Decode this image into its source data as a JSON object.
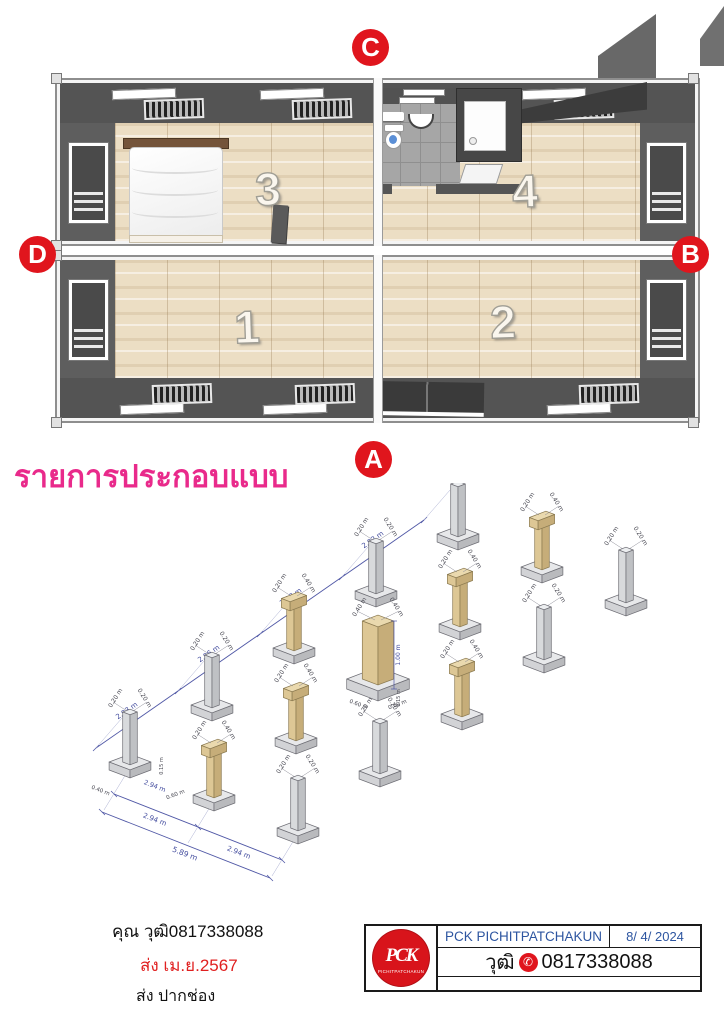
{
  "plan": {
    "rooms": [
      {
        "label": "1"
      },
      {
        "label": "2"
      },
      {
        "label": "3"
      },
      {
        "label": "4"
      }
    ],
    "markers": [
      {
        "label": "A"
      },
      {
        "label": "B"
      },
      {
        "label": "C"
      },
      {
        "label": "D"
      }
    ]
  },
  "section_title": "รายการประกอบแบบ",
  "foundation": {
    "type": "isometric-foundation-plan",
    "grid": {
      "rows": 5,
      "cols": 3
    },
    "pillars": [
      {
        "i": 0,
        "j": 0,
        "type": "small",
        "top": [
          "0.20 m",
          "0.20 m"
        ]
      },
      {
        "i": 1,
        "j": 0,
        "type": "small",
        "top": [
          "0.20 m",
          "0.20 m"
        ]
      },
      {
        "i": 2,
        "j": 0,
        "type": "cap",
        "top": [
          "0.20 m",
          "0.40 m"
        ]
      },
      {
        "i": 3,
        "j": 0,
        "type": "small",
        "top": [
          "0.20 m",
          "0.20 m"
        ]
      },
      {
        "i": 4,
        "j": 0,
        "type": "small",
        "top": [
          "0.20 m",
          "0.20 m"
        ]
      },
      {
        "i": 0,
        "j": 1,
        "type": "cap",
        "top": [
          "0.20 m",
          "0.40 m"
        ]
      },
      {
        "i": 1,
        "j": 1,
        "type": "cap",
        "top": [
          "0.20 m",
          "0.40 m"
        ]
      },
      {
        "i": 2,
        "j": 1,
        "type": "large",
        "top": [
          "0.40 m",
          "0.40 m"
        ]
      },
      {
        "i": 3,
        "j": 1,
        "type": "cap",
        "top": [
          "0.20 m",
          "0.40 m"
        ]
      },
      {
        "i": 4,
        "j": 1,
        "type": "cap",
        "top": [
          "0.20 m",
          "0.40 m"
        ]
      },
      {
        "i": 0,
        "j": 2,
        "type": "small",
        "top": [
          "0.20 m",
          "0.20 m"
        ]
      },
      {
        "i": 1,
        "j": 2,
        "type": "small",
        "top": [
          "0.20 m",
          "0.20 m"
        ]
      },
      {
        "i": 2,
        "j": 2,
        "type": "cap",
        "top": [
          "0.20 m",
          "0.40 m"
        ]
      },
      {
        "i": 3,
        "j": 2,
        "type": "small",
        "top": [
          "0.20 m",
          "0.20 m"
        ]
      },
      {
        "i": 4,
        "j": 2,
        "type": "small",
        "top": [
          "0.20 m",
          "0.20 m"
        ]
      }
    ],
    "back_edge_dims": [
      "2.93 m",
      "2.96 m",
      "2.98 m",
      "2.92 m"
    ],
    "front_edge_dims": [
      "2.94 m",
      "2.94 m"
    ],
    "front_edge_total": "5.89 m",
    "large_pillar": {
      "height": "1.00 m",
      "base_height": "0.15 m",
      "base_w": "0.60 m",
      "base_d": "0.60 m"
    },
    "corner_pillar": {
      "offset": "0.40 m",
      "bay": "2.94 m",
      "base_w": "0.60 m",
      "base_height": "0.15 m"
    }
  },
  "contact": {
    "line1": "คุณ วุฒิ0817338088",
    "line2": "ส่ง    เม.ย.2567",
    "line3": "ส่ง ปากช่อง"
  },
  "titleblock": {
    "company": "PCK PICHITPATCHAKUN",
    "date": "8/ 4/ 2024",
    "person": "วุฒิ",
    "phone": "0817338088",
    "logo_text": "PCK",
    "logo_caption": "PICHITPATCHAKUN"
  },
  "icons": {
    "phone": "✆"
  },
  "colors": {
    "marker_red": "#e0151d",
    "title_pink": "#e92a8b",
    "dim_blue": "#5058a6",
    "titleblock_blue": "#2d55a0",
    "wood_floor": "#ecdec4",
    "wall_gray": "#5e5e5e",
    "pillar_tan": "#ead9ae",
    "pillar_gray": "#eceef0"
  }
}
